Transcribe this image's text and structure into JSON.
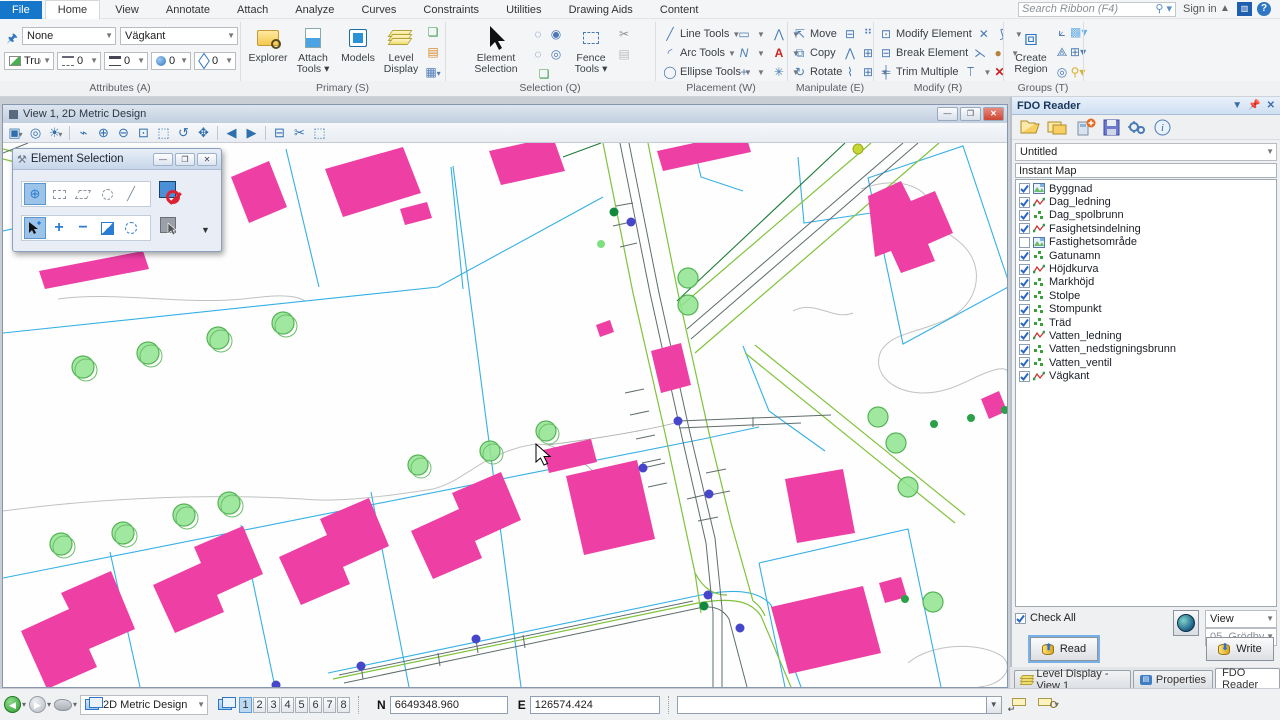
{
  "ribbon": {
    "tabs": [
      "File",
      "Home",
      "View",
      "Annotate",
      "Attach",
      "Analyze",
      "Curves",
      "Constraints",
      "Utilities",
      "Drawing Aids",
      "Content"
    ],
    "active_tab": "Home",
    "search_placeholder": "Search Ribbon (F4)",
    "sign_in": "Sign in",
    "group_labels": [
      "Attributes (A)",
      "Primary (S)",
      "Selection (Q)",
      "Placement (W)",
      "Manipulate (E)",
      "Modify (R)",
      "Groups (T)"
    ],
    "attributes": {
      "template": "None",
      "level": "Vägkant",
      "color": "True C",
      "style": "0",
      "weight": "0",
      "class": "0",
      "priority": "0"
    },
    "primary": {
      "explorer": "Explorer",
      "attach_tools": "Attach Tools",
      "models": "Models",
      "level_display": "Level Display"
    },
    "selection": {
      "element_selection": "Element Selection",
      "fence_tools": "Fence Tools"
    },
    "placement": {
      "line_tools": "Line Tools",
      "arc_tools": "Arc Tools",
      "ellipse_tools": "Ellipse Tools"
    },
    "manipulate": {
      "move": "Move",
      "copy": "Copy",
      "rotate": "Rotate"
    },
    "modify": {
      "modify_element": "Modify Element",
      "break_element": "Break Element",
      "trim_multiple": "Trim Multiple"
    },
    "groups": {
      "create_region": "Create Region"
    }
  },
  "view_window": {
    "title": "View 1, 2D Metric Design"
  },
  "element_selection_dialog": {
    "title": "Element Selection"
  },
  "fdo_panel": {
    "title": "FDO Reader",
    "dataset": "Untitled",
    "map_name": "Instant Map",
    "layers": [
      {
        "name": "Byggnad",
        "type": "polygon",
        "checked": true
      },
      {
        "name": "Dag_ledning",
        "type": "line",
        "checked": true
      },
      {
        "name": "Dag_spolbrunn",
        "type": "point",
        "checked": true
      },
      {
        "name": "Fasighetsindelning",
        "type": "line",
        "checked": true
      },
      {
        "name": "Fastighetsområde",
        "type": "polygon",
        "checked": false
      },
      {
        "name": "Gatunamn",
        "type": "point",
        "checked": true
      },
      {
        "name": "Höjdkurva",
        "type": "line",
        "checked": true
      },
      {
        "name": "Markhöjd",
        "type": "point",
        "checked": true
      },
      {
        "name": "Stolpe",
        "type": "point",
        "checked": true
      },
      {
        "name": "Stompunkt",
        "type": "point",
        "checked": true
      },
      {
        "name": "Träd",
        "type": "point",
        "checked": true
      },
      {
        "name": "Vatten_ledning",
        "type": "line",
        "checked": true
      },
      {
        "name": "Vatten_nedstigningsbrunn",
        "type": "point",
        "checked": true
      },
      {
        "name": "Vatten_ventil",
        "type": "point",
        "checked": true
      },
      {
        "name": "Vägkant",
        "type": "line",
        "checked": true
      }
    ],
    "check_all": "Check All",
    "view_combo": "View",
    "area_combo": "05_Grödby",
    "read_button": "Read",
    "write_button": "Write",
    "tabs": [
      "Level Display - View 1",
      "Properties",
      "FDO Reader"
    ],
    "active_tab": "FDO Reader"
  },
  "status_bar": {
    "model": "2D Metric Design",
    "view_numbers": [
      "1",
      "2",
      "3",
      "4",
      "5",
      "6",
      "7",
      "8"
    ],
    "active_view": "1",
    "n_label": "N",
    "n_value": "6649348.960",
    "e_label": "E",
    "e_value": "126574.424"
  },
  "colors": {
    "building": "#ee3fa5",
    "parcel": "#35b0e5",
    "road_edge": "#80c33c",
    "tree_fill": "#8fe48f",
    "water_point": "#4646cb",
    "accent_blue": "#1577c9"
  }
}
